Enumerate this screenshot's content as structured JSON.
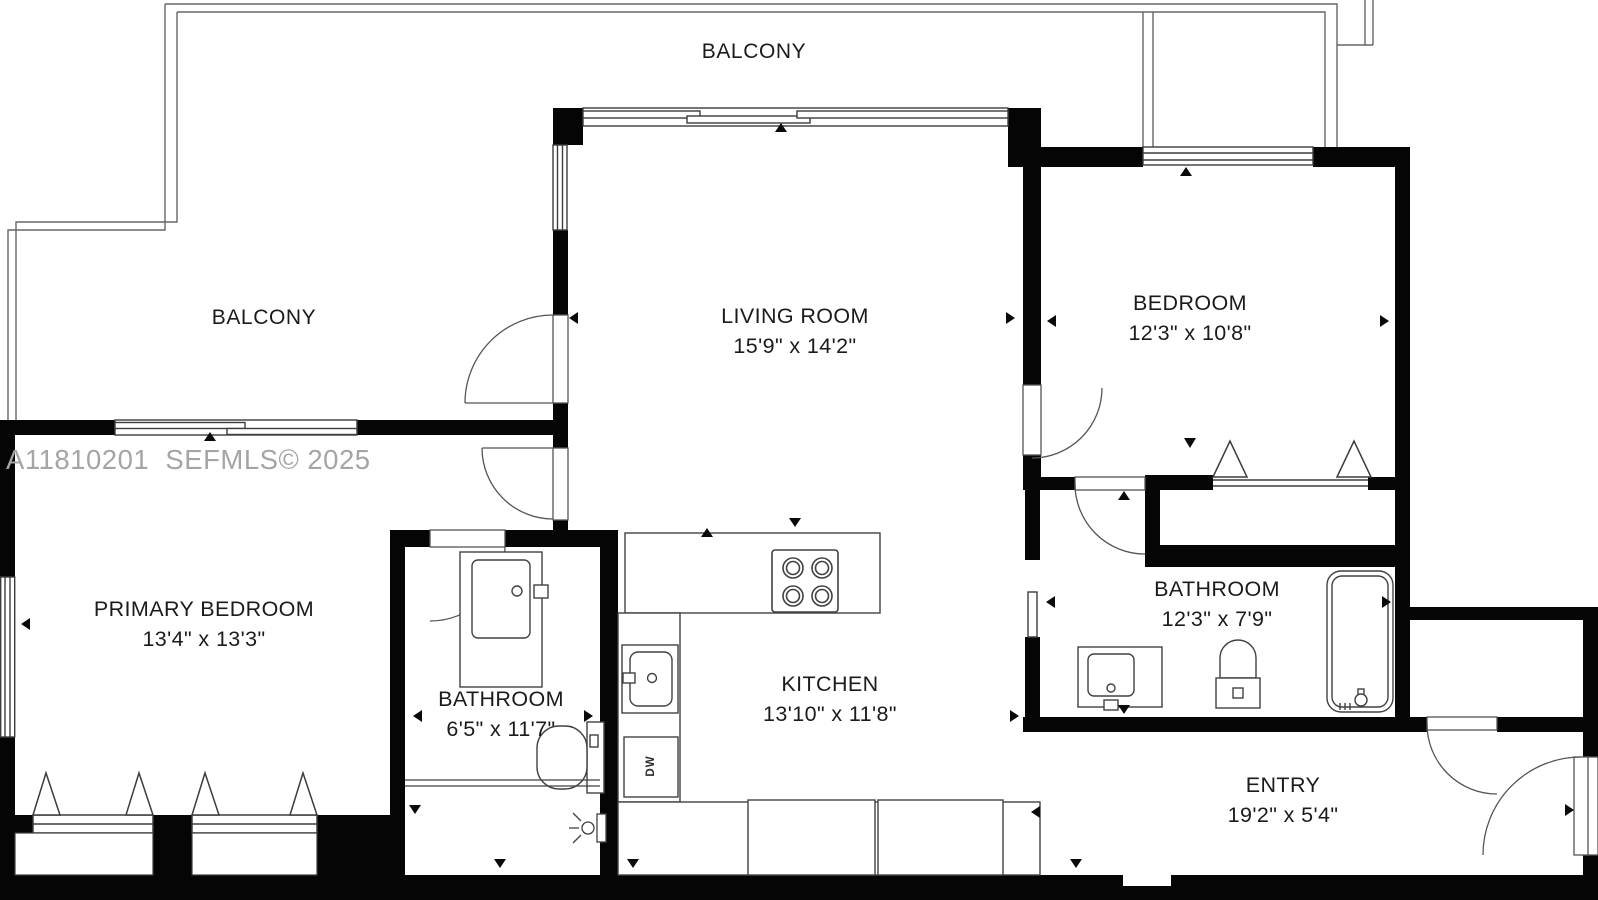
{
  "watermark": "A11810201  SEFMLS© 2025",
  "rooms": {
    "balcony_top": {
      "name": "BALCONY"
    },
    "balcony_left": {
      "name": "BALCONY"
    },
    "living_room": {
      "name": "LIVING ROOM",
      "size": "15'9\" x 14'2\""
    },
    "bedroom": {
      "name": "BEDROOM",
      "size": "12'3\" x 10'8\""
    },
    "primary_bedroom": {
      "name": "PRIMARY BEDROOM",
      "size": "13'4\" x 13'3\""
    },
    "primary_bathroom": {
      "name": "BATHROOM",
      "size": "6'5\" x 11'7\""
    },
    "kitchen": {
      "name": "KITCHEN",
      "size": "13'10\" x 11'8\""
    },
    "hall_bathroom": {
      "name": "BATHROOM",
      "size": "12'3\" x 7'9\""
    },
    "entry": {
      "name": "ENTRY",
      "size": "19'2\" x 5'4\""
    }
  },
  "appliance_labels": {
    "dishwasher": "DW"
  },
  "colors": {
    "wall": "#050505",
    "fixture_line": "#414141",
    "railing_line": "#666666",
    "label_text": "#1b1b1b",
    "watermark_text": "#a5a5a5",
    "background": "#ffffff"
  }
}
